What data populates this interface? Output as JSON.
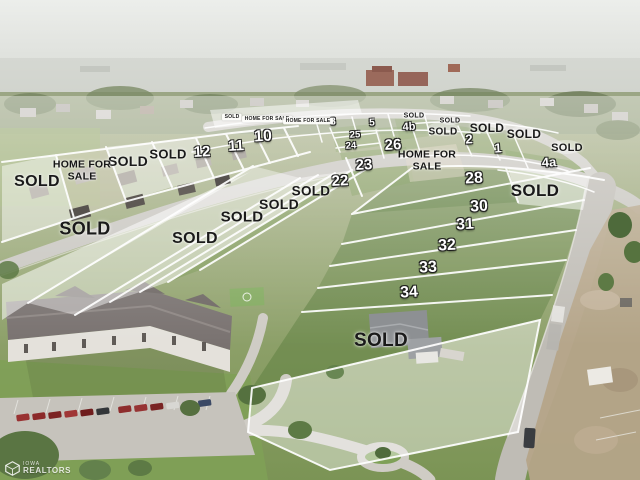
{
  "map": {
    "sold_text": "SOLD",
    "home_for_sale_line1": "HOME FOR",
    "home_for_sale_line2": "SALE",
    "sign_pills": [
      {
        "label": "SOLD",
        "x": 232,
        "y": 117
      },
      {
        "label": "HOME FOR SALE",
        "x": 267,
        "y": 119
      },
      {
        "label": "HOME FOR SALE",
        "x": 308,
        "y": 121
      }
    ],
    "sold_labels": [
      {
        "x": 37,
        "y": 182,
        "fs": 16
      },
      {
        "x": 85,
        "y": 229,
        "fs": 18
      },
      {
        "x": 128,
        "y": 161,
        "fs": 14
      },
      {
        "x": 168,
        "y": 154,
        "fs": 13
      },
      {
        "x": 195,
        "y": 239,
        "fs": 16
      },
      {
        "x": 242,
        "y": 217,
        "fs": 15
      },
      {
        "x": 279,
        "y": 204,
        "fs": 14
      },
      {
        "x": 311,
        "y": 191,
        "fs": 13.5
      },
      {
        "x": 414,
        "y": 116,
        "fs": 7
      },
      {
        "x": 450,
        "y": 121,
        "fs": 7
      },
      {
        "x": 443,
        "y": 132,
        "fs": 10
      },
      {
        "x": 487,
        "y": 128,
        "fs": 12
      },
      {
        "x": 524,
        "y": 134,
        "fs": 12
      },
      {
        "x": 567,
        "y": 148,
        "fs": 11
      },
      {
        "x": 535,
        "y": 191,
        "fs": 17
      },
      {
        "x": 381,
        "y": 341,
        "fs": 19
      }
    ],
    "home_for_sale_labels": [
      {
        "x": 82,
        "y": 171,
        "fs": 10.5
      },
      {
        "x": 427,
        "y": 161,
        "fs": 10.5
      }
    ],
    "lot_numbers": [
      {
        "n": "12",
        "x": 202,
        "y": 152,
        "fs": 15
      },
      {
        "n": "11",
        "x": 236,
        "y": 146,
        "fs": 15
      },
      {
        "n": "10",
        "x": 263,
        "y": 137,
        "fs": 16
      },
      {
        "n": "8",
        "x": 333,
        "y": 122,
        "fs": 10
      },
      {
        "n": "5",
        "x": 372,
        "y": 123,
        "fs": 10
      },
      {
        "n": "4b",
        "x": 409,
        "y": 127,
        "fs": 11
      },
      {
        "n": "2",
        "x": 469,
        "y": 139,
        "fs": 13
      },
      {
        "n": "1",
        "x": 498,
        "y": 148,
        "fs": 13
      },
      {
        "n": "4a",
        "x": 549,
        "y": 162,
        "fs": 13
      },
      {
        "n": "25",
        "x": 355,
        "y": 135,
        "fs": 9.5
      },
      {
        "n": "24",
        "x": 351,
        "y": 146,
        "fs": 9.5
      },
      {
        "n": "26",
        "x": 393,
        "y": 145,
        "fs": 15
      },
      {
        "n": "23",
        "x": 364,
        "y": 165,
        "fs": 15
      },
      {
        "n": "22",
        "x": 340,
        "y": 181,
        "fs": 15
      },
      {
        "n": "28",
        "x": 474,
        "y": 179,
        "fs": 16
      },
      {
        "n": "30",
        "x": 479,
        "y": 207,
        "fs": 16
      },
      {
        "n": "31",
        "x": 465,
        "y": 225,
        "fs": 16
      },
      {
        "n": "32",
        "x": 447,
        "y": 246,
        "fs": 16
      },
      {
        "n": "33",
        "x": 428,
        "y": 268,
        "fs": 16
      },
      {
        "n": "34",
        "x": 409,
        "y": 293,
        "fs": 16
      }
    ]
  },
  "watermark": {
    "line1": "IOWA",
    "line2": "REALTORS"
  },
  "palette": {
    "sold_text": "#1a1a1a",
    "lot_number_text": "#ffffff",
    "lot_line": "#ffffff",
    "sold_fill_overlay": "rgba(255,255,255,0.45)",
    "grass": "#8aa061",
    "vivid_lot_green": "#5e8040",
    "road": "#c9c7c1",
    "sky_haze": "#e8e9e6",
    "dirt": "#b5a489"
  }
}
